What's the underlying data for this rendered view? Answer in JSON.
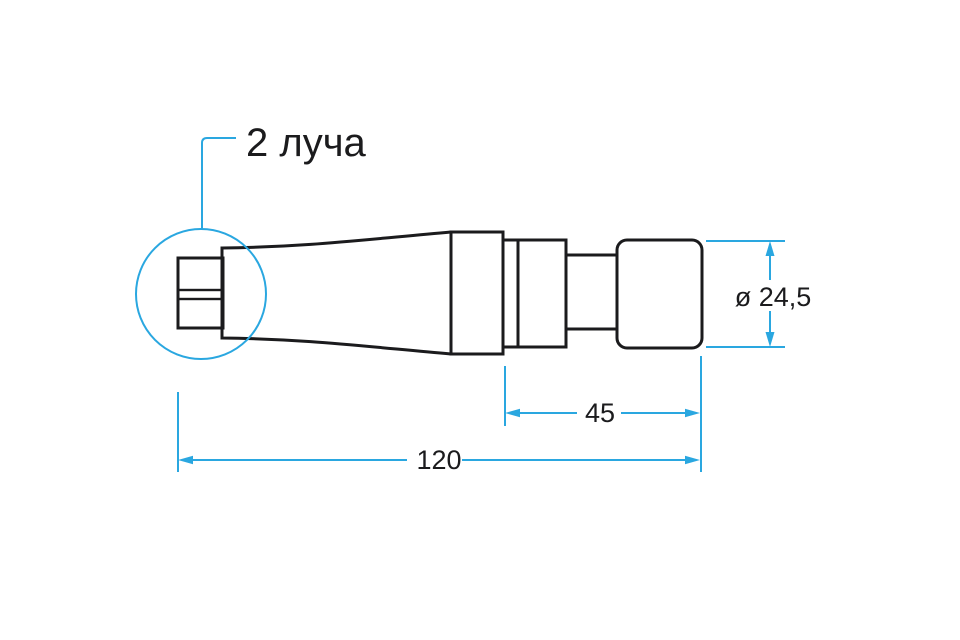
{
  "drawing": {
    "callout": {
      "label": "2 луча"
    },
    "dimensions": {
      "diameter_label": "ø 24,5",
      "front_section_label": "45",
      "total_length_label": "120"
    },
    "colors": {
      "accent_blue": "#2AA7E0",
      "outline_black": "#1B1B1D",
      "background": "#FFFFFF"
    }
  }
}
